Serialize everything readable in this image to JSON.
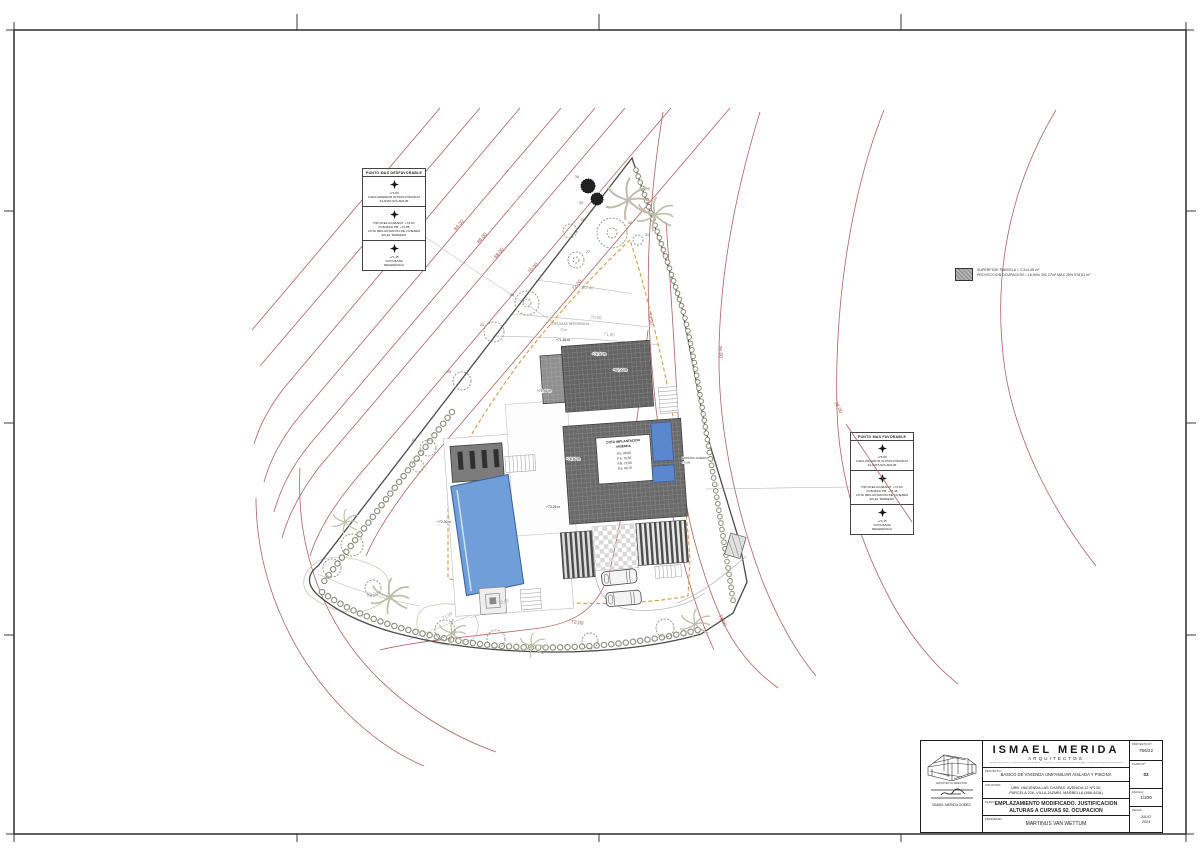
{
  "legend": {
    "line1": "SUPERFICIE PARCELA = 2.314,45 m²",
    "line2": "PROYECCION OCUPACION = 16,94% 392,27m² MAX 25% 578,61 m²"
  },
  "boxes": {
    "desfavorable": {
      "title": "PUNTO MAS DESFAVORABLE",
      "cells": [
        "+73,00\nCARA INFERIOR ULTIMO FORJADO\nPLANTA SOLARIUM",
        "PB NIVEL ACABADO: +73,00\nFORJADO PB: +72,85\nCOTA IMPLANTACIÓN DE VIVIENDA\nEN EL TERRENO",
        "+71,15\nCOTA BASE\nREFERENCIA"
      ]
    },
    "favorable": {
      "title": "PUNTO MAS FAVORABLE",
      "cells": [
        "+75,60\nCARA INFERIOR ULTIMO FORJADO\nPLANTA SOLARIUM",
        "PB NIVEL ACABADO: +73,60\nFORJADO PB: +73,45\nCOTA IMPLANTACIÓN DE VIVIENDA\nEN EL TERRENO",
        "+74,15\nCOTA BASE\nREFERENCIA"
      ]
    }
  },
  "plan": {
    "contour_labels_red": [
      "64,00",
      "66,00",
      "68,00",
      "70,00",
      "72,00",
      "74,00",
      "76,00",
      "78,00",
      "72,00",
      "73,00"
    ],
    "contour_labels_gray": [
      "69,00",
      "70,00",
      "71,00",
      "69,00",
      "71,00",
      "72,00"
    ],
    "level_labels": [
      "+71,65 m",
      "+76,50 m",
      "+80,00 m",
      "+71,45 m",
      "+76,50 m",
      "+73,26 m",
      "+72,00 m"
    ],
    "cota_box": [
      "COTA IMPLANTACION",
      "VIVIENDA",
      "P.S.  80,00",
      "P.A.  76,50",
      "P.B.  73,00",
      "P.S.  69,70"
    ],
    "entrada": [
      "ENTRADA VIVIENDA",
      "+72,85"
    ],
    "base_ref": [
      "COTA BASE REFERENCIA",
      "72 m"
    ],
    "tree_numbers": [
      "30",
      "28",
      "27",
      "26",
      "23",
      "25",
      "24",
      "31",
      "34",
      "33"
    ]
  },
  "titleblock": {
    "firm_name": "ISMAEL MERIDA",
    "firm_sub": "ARQUITECTOS",
    "firm_address": "Avenida de Asturias · Urbanización Real Zaragoza 3 · Oficina 5D 1ª Planta · Marbella (Málaga) · e-mail: estudio@ismaelmerida.com",
    "director_label": "ARQUITECTO DIRECTOR",
    "director_name": "ISMAEL MERIDA GOMEZ",
    "rows": {
      "proyecto_label": "PROYECTO:",
      "proyecto": "BASICO DE VIVIENDA UNIFAMILIAR AISLADA Y PISCINA",
      "situacion_label": "SITUACION:",
      "situacion": "URB. HACIENDA LAS CHAPAS, AVENIDA 12 Nº13V,\nPARCELA 226, VILLA JAZMIN, MARBELLA (MALAGA)",
      "plano_label": "PLANO:",
      "plano": "EMPLAZAMIENTO MODIFICADO. JUSTIFICACION\nALTURAS A CURVAS 92. OCUPACION",
      "propiedad_label": "PROPIEDAD:",
      "propiedad": "MARTINUS VAN WETTUM"
    },
    "meta": {
      "proyecto_no_label": "PROYECTO Nº:",
      "proyecto_no": "766/22",
      "plano_no_label": "PLANO Nº:",
      "plano_no": "03",
      "escala_label": "ESCALA:",
      "escala": "1/200",
      "fecha_label": "FECHA:",
      "fecha": "JULIO\n2023"
    }
  },
  "colors": {
    "contour_red": "#b06060",
    "setback_orange": "#d79b3f",
    "pool_blue": "#6f9ed8",
    "roof_dark": "#686868"
  }
}
